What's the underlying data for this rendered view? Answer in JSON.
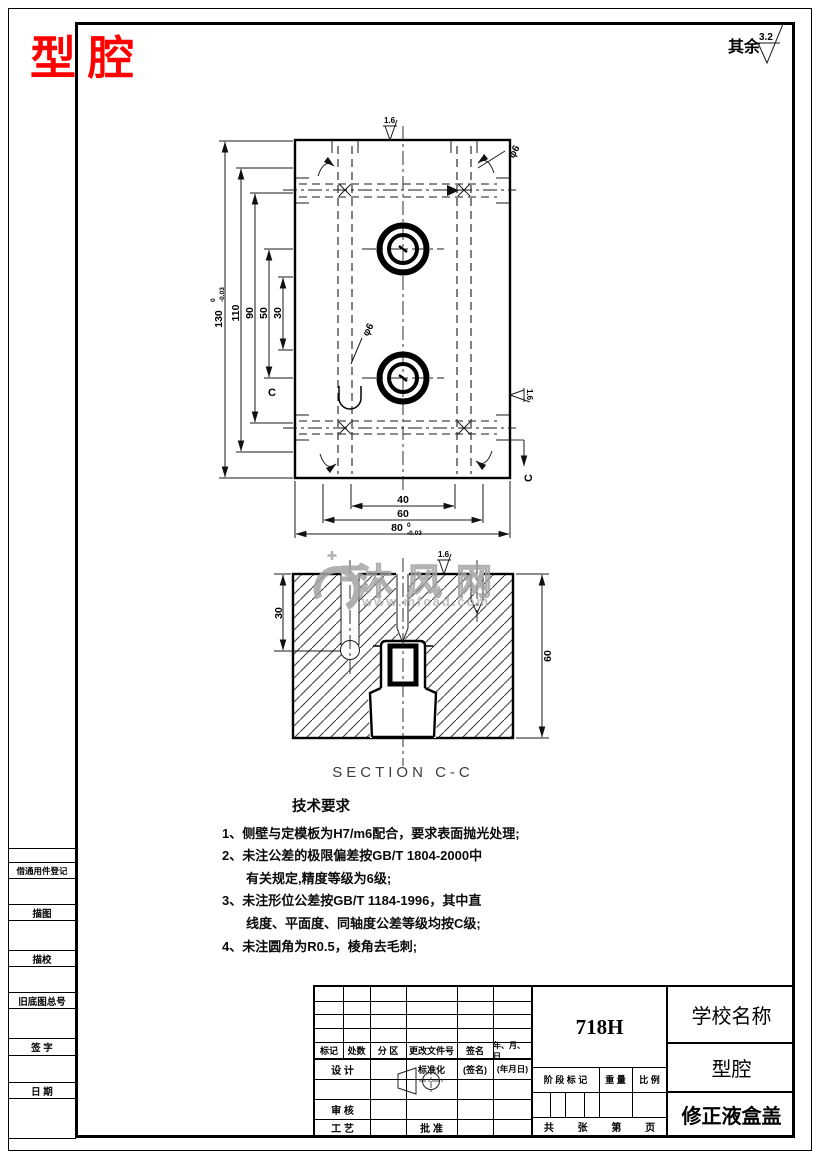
{
  "sheet": {
    "title": "型腔",
    "surplus_label": "其余",
    "surplus_value": "3.2"
  },
  "top_view": {
    "dim_height": {
      "v": "130",
      "tu": "0",
      "td": "-0.03"
    },
    "dim_110": "110",
    "dim_90": "90",
    "dim_50": "50",
    "dim_30": "30",
    "dim_40": "40",
    "dim_60": "60",
    "dim_width": {
      "v": "80",
      "tu": "0",
      "td": "-0.03"
    },
    "phi_top": "φ6",
    "phi_side": "φ6",
    "rough_top": "1.6",
    "rough_side": "1.6",
    "section_c_left": "C",
    "section_c_bottom": "C"
  },
  "section_view": {
    "caption": "SECTION C-C",
    "dim_depth": "30",
    "dim_height": "60",
    "rough": "1.6"
  },
  "watermark": {
    "brand": "沐风网",
    "site": "www.mfcad.com"
  },
  "tech_requirements": {
    "heading": "技术要求",
    "lines": [
      {
        "text": "1、侧壁与定模板为H7/m6配合，要求表面抛光处理;",
        "indent": false
      },
      {
        "text": "2、未注公差的极限偏差按GB/T 1804-2000中",
        "indent": false
      },
      {
        "text": "有关规定,精度等级为6级;",
        "indent": true
      },
      {
        "text": "3、未注形位公差按GB/T 1184-1996，其中直",
        "indent": false
      },
      {
        "text": "线度、平面度、同轴度公差等级均按C级;",
        "indent": true
      },
      {
        "text": "4、未注圆角为R0.5，棱角去毛刺;",
        "indent": false
      }
    ]
  },
  "title_block": {
    "material": "718H",
    "school": "学校名称",
    "part_name": "型腔",
    "product_name": "修正液盒盖",
    "rev_headers": [
      "标记",
      "处数",
      "分 区",
      "更改文件号",
      "签名",
      "年、月、日"
    ],
    "design": "设 计",
    "standardization": "标准化",
    "sign_hint": "(签名)",
    "date_hint": "(年月日)",
    "review": "审 核",
    "process": "工 艺",
    "approve": "批 准",
    "stage": "阶 段 标 记",
    "weight": "重 量",
    "scale": "比 例",
    "sheets": {
      "total_label": "共",
      "sheet_unit": "张",
      "page_label": "第",
      "page_unit": "页"
    }
  },
  "margin_strip": {
    "labels": [
      "借通用件登记",
      "描图",
      "描校",
      "旧底图总号",
      "签 字",
      "日 期"
    ]
  }
}
